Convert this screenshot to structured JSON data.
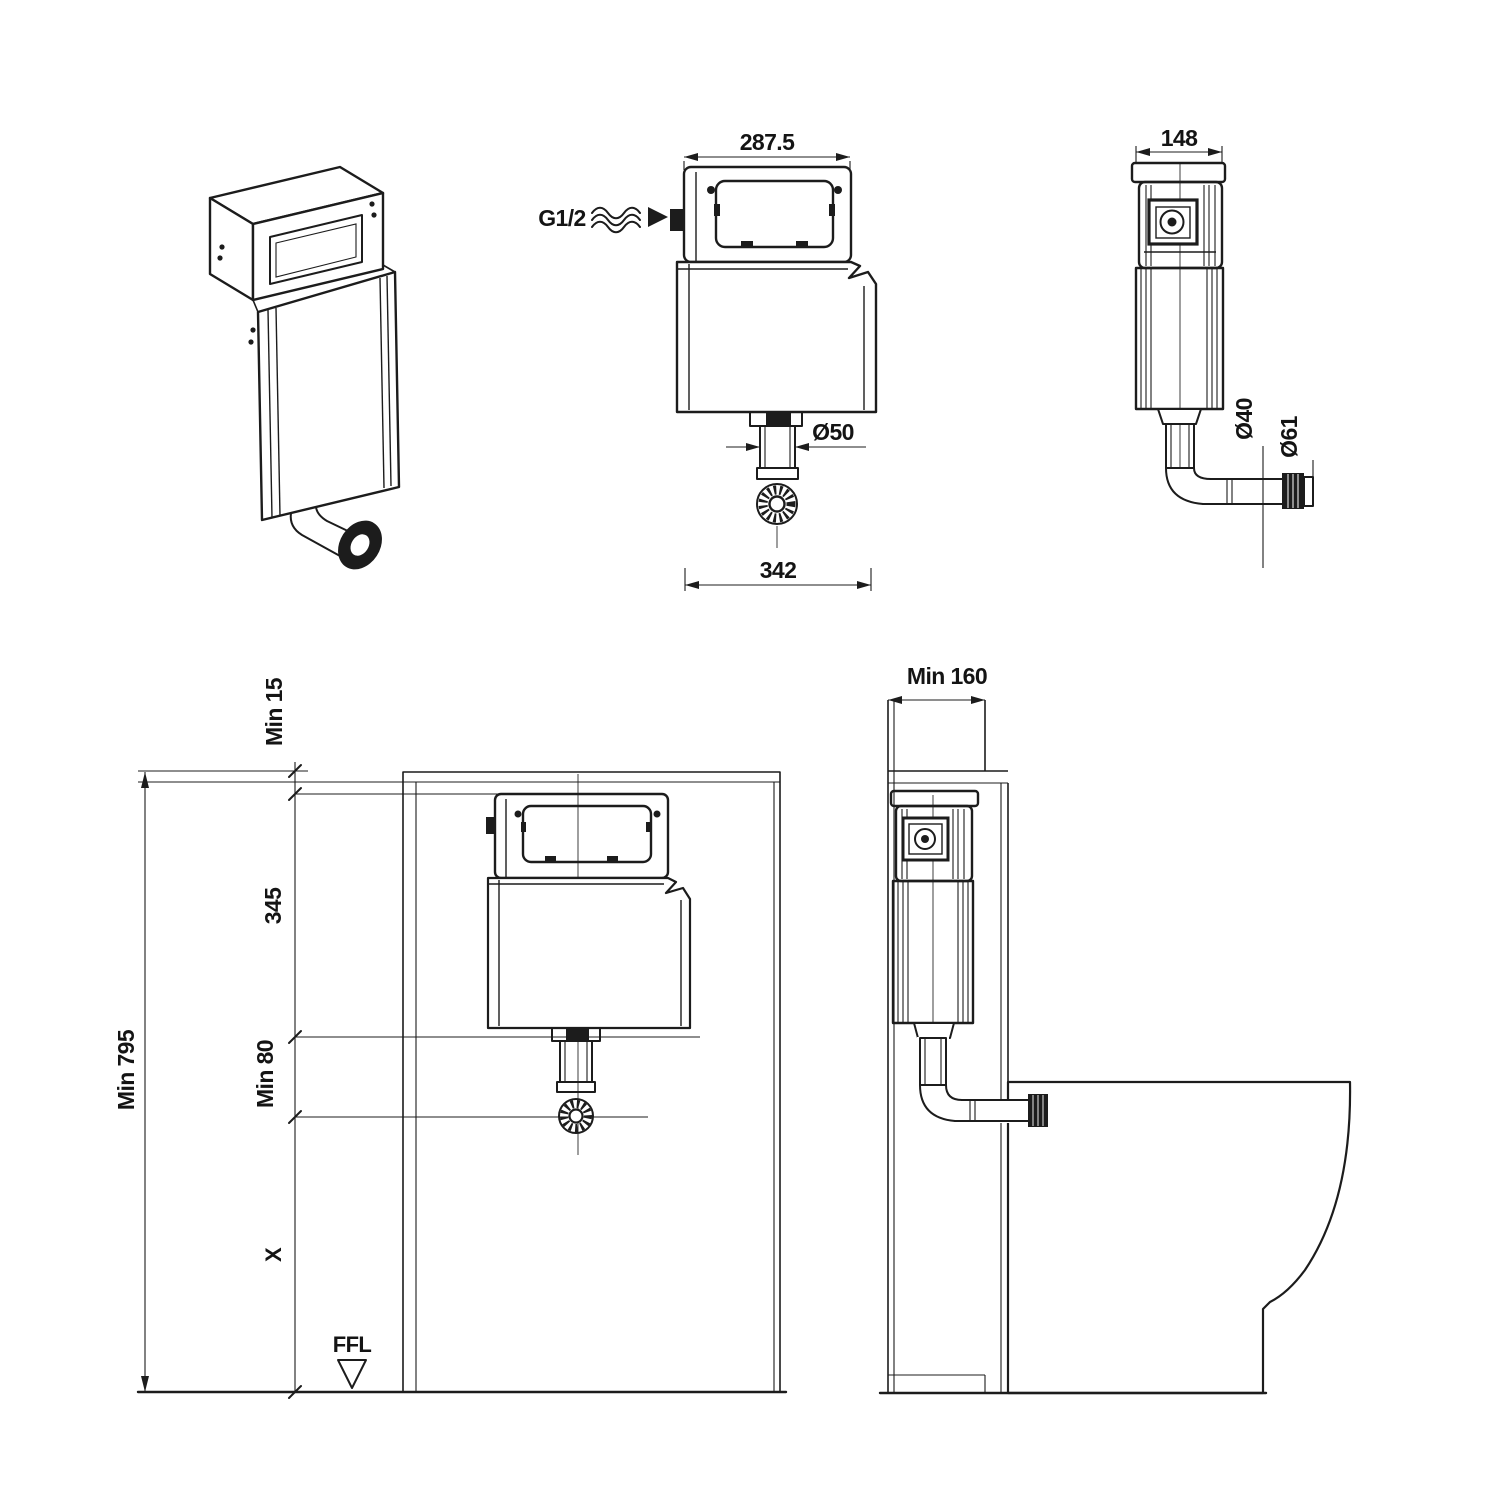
{
  "colors": {
    "line": "#1c1c1c",
    "background": "#ffffff"
  },
  "views": {
    "front": {
      "top_width": "287.5",
      "bottom_width": "342",
      "inlet_thread": "G1/2",
      "outlet_diameter": "Ø50"
    },
    "side": {
      "width": "148",
      "flush_pipe_diameter": "Ø40",
      "connector_diameter": "Ø61"
    },
    "installation_front": {
      "top_clearance": "Min 15",
      "cistern_height": "345",
      "outlet_drop": "Min 80",
      "overall_height": "Min 795",
      "pan_connection_height": "X",
      "finished_floor_level": "FFL"
    },
    "installation_side": {
      "wall_cavity_depth": "Min 160"
    }
  }
}
